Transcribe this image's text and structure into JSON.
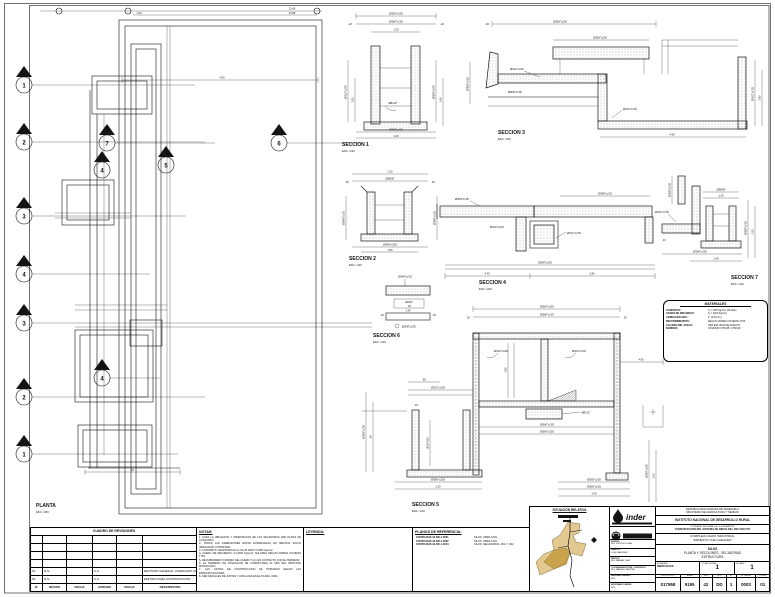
{
  "plan": {
    "title": "PLANTA",
    "scale": "ESC: 1/50",
    "markers": [
      "1",
      "2",
      "3",
      "4",
      "3",
      "2",
      "1",
      "7",
      "6",
      "5",
      "4",
      "4"
    ]
  },
  "sections": {
    "s1": {
      "label": "SECCION 1",
      "scale": "ESC: 1/20"
    },
    "s2": {
      "label": "SECCION 2",
      "scale": "ESC: 1/20"
    },
    "s3": {
      "label": "SECCION 3",
      "scale": "ESC: 1/20"
    },
    "s4": {
      "label": "SECCION 4",
      "scale": "ESC: 1/20"
    },
    "s5": {
      "label": "SECCION 5",
      "scale": "ESC: 1/20"
    },
    "s6": {
      "label": "SECCION 6",
      "scale": "ESC: 1/10"
    },
    "s7": {
      "label": "SECCION 7",
      "scale": "ESC: 1/10"
    }
  },
  "rebar": {
    "r1": "Ø3/8\"c/20",
    "r2": "Ø3/8\"c/15",
    "r3": "Ø1/2\"c/20",
    "r4": "Ø1/2\"c/15",
    "r5": "4Ø1/2\"",
    "r6": "2Ø5/8\"",
    "r7": "Ø3/8\"c/25",
    "r8": "3Ø3/8\""
  },
  "dims": {
    "d1": "1.40",
    "d2": ".20",
    "d3": ".15",
    "d4": "3.40",
    "d5": "1.50",
    "d6": ".60",
    "d7": "2.80",
    "d8": "4.90",
    "d9": "13.40",
    "d10": ".30",
    "d11": "1.20",
    "d12": ".25",
    "d13": "13.58"
  },
  "materials_box": {
    "title": "MATERIALES",
    "rows": [
      [
        "CONCRETO:",
        "f'c = 250 Kg/cm² (28 dias)"
      ],
      [
        "ACERO DE REFUERZO:",
        "fy = 4200 Kg/cm²"
      ],
      [
        "AGREGADO MAX.:",
        "1\" (2.54 cm)"
      ],
      [
        "RECUBRIMIENTOS:",
        "SEGUN NORMA COVENIN 1753"
      ],
      [
        "CALIDAD DEL SUELO:",
        "VER ESTUDIO DE SUELOS"
      ],
      [
        "NORMAS:",
        "COVENIN 1753-85 / 1756-98"
      ]
    ]
  },
  "revisions": {
    "title": "CUADRO DE REVISIONES",
    "headers": [
      "N°",
      "REVISO",
      "FECHA",
      "APROBO",
      "FECHA",
      "DESCRIPCION"
    ],
    "rows": [
      [
        "01",
        "R.G.",
        "",
        "A.A.",
        "",
        "REVISION GENERAL. AGREGADO ACERO DE REFUERZO"
      ],
      [
        "00",
        "R.G.",
        "",
        "A.A.",
        "",
        "EMITIDO PARA CONSTRUCCION"
      ]
    ]
  },
  "notas": {
    "title": "NOTAS:",
    "lines": [
      "1- PARA LA UBICACION Y ORIENTACION DE LAS SECADORAS VER PLANO DE CONJUNTO.",
      "2- TODAS LAS DIMENSIONES ESTAN EXPRESADAS EN METROS SALVO INDICACION CONTRARIA.",
      "3- CONCRETO: RESISTENCIA A LOS 28 DIAS f'c=250 Kg/cm2.",
      "4- ACERO DE REFUERZO: fy=4200 Kg/cm2. SOLAPES SEGUN NORMA COVENIN 1753.",
      "5- RECUBRIMIENTO MINIMO DEL ACERO: 5 cm EN CONTACTO CON EL TERRENO.",
      "6- EL TERRENO DE FUNDACION SE COMPACTARA AL 95% DEL PROCTOR MODIFICADO.",
      "7- LAS JUNTAS DE CONSTRUCCION SE TRATARAN SEGUN LAS ESPECIFICACIONES.",
      "8- VER DETALLES DE JUNTAS Y ANCLAJES EN EL PLANO -0004."
    ]
  },
  "leyenda": {
    "title": "LEYENDA:"
  },
  "planos_ref": {
    "title": "PLANOS DE REFERENCIA:",
    "rows": [
      [
        "017958-9195-42-DD-1-0001",
        "SILOS. OBRA CIVIL"
      ],
      [
        "017958-9195-42-DD-1-0002",
        "SILOS. OBRA CIVIL"
      ],
      [
        "017958-9195-42-DD-1-0004",
        "SILOS. SECADORAS -001 Y -002"
      ]
    ]
  },
  "situacion": {
    "title": "SITUACION RELATIVA"
  },
  "titleblock": {
    "logo1_text": "inder",
    "country_line1": "REPUBLICA BOLIVARIANA DE VENEZUELA",
    "country_line2": "MINISTERIO DE AGRICULTURA Y TIERRAS",
    "institute": "INSTITUTO NACIONAL DE DESARROLLO RURAL",
    "program_line1": "CONVENIO INTEGRAL DE COOPERACION",
    "program_line2": "CONSTRUCCION DEL SISTEMA DE RIEGO DEL RIO TOCUYO",
    "project_line1": "COMPLEJO AGRO INDUSTRIAL",
    "project_line2": "\"ERNESTO CHE GUEVARA\"",
    "subject_line1": "SILOS",
    "subject_line2": "PLANTA Y SECCIONES - SECADORAS",
    "subject_line3": "ESTRUCTURA",
    "escalas_label": "ESCALAS:",
    "escalas_value": "INDICADAS",
    "total_hojas_label": "TOTAL HOJAS:",
    "total_hojas_value": "1",
    "hoja_label": "HOJA N°:",
    "hoja_value": "1",
    "code_headers": [
      "PROYECTO N°",
      "AREA",
      "DIS",
      "DOC",
      "ET",
      "N° DIBUJO",
      "N° REV"
    ],
    "code_values": [
      "017958",
      "9195",
      "42",
      "DD",
      "1",
      "0003",
      "01"
    ],
    "left_rows": [
      [
        "DISEÑO:",
        "ING. ESTRUCTURAL"
      ],
      [
        "DIBUJO:",
        "JOSE SANCHEZ"
      ],
      [
        "REVISO:",
        "ING. RAFAEL DIAZ"
      ],
      [
        "COORDINADOR DEL CONTRATO:",
        "ING. MANUEL MEDINA"
      ],
      [
        "REVISADO INDER:",
        "ING."
      ],
      [
        "APROBADO INDER:",
        "ING."
      ]
    ]
  }
}
